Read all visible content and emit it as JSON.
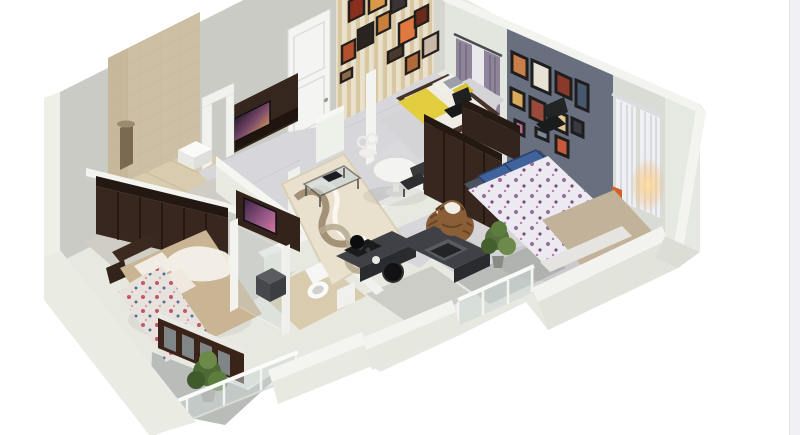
{
  "meta": {
    "title": "3D isometric floor plan render - two-bedroom apartment",
    "render_style": "photorealistic cutaway dollhouse view",
    "visible_text": ""
  },
  "canvas": {
    "width": 800,
    "height": 435,
    "background": "#ffffff"
  },
  "scrollbar": {
    "track_color": "#f1f1f3",
    "edge_color": "#e4e4e8"
  },
  "colors": {
    "wall_mass": "#e7e9e1",
    "wall_gray": "#c9cbc4",
    "wall_cap": "#f3f4f0",
    "wall_window": "#e3e5df",
    "accent_wall": "#68707f",
    "wall_right": "#d9dbd5",
    "wall_right_outer": "#e6e8e2",
    "wallpaper_a": "#f2ead6",
    "wallpaper_b": "#dfcea6",
    "tile_wall": "#cdbfa4",
    "floor_marble": "#d7d7db",
    "floor_master": "#d0cdc6",
    "floor_bath": "#d8cbae",
    "floor_balcony": "#b9bcb9",
    "floor_bed2": "#d6d4d6",
    "counter_top": "#3f4146",
    "counter_front": "#292b2f",
    "wood_dark": "#38271e",
    "wood_door": "#3a241a",
    "door_white": "#f4f4f2",
    "bed_tan": "#c9b494",
    "duvet_floral": "#eceaf0",
    "blanket_beige": "#c2b299",
    "pillow_blue": "#41639c",
    "throw_yellow": "#e2cd3f",
    "curtain_purple": "#8f8499",
    "curtain_white": "#eef0f3",
    "plant_green": "#55703c",
    "glass": "#ccd6d6",
    "rug_base": "#e9e1cd",
    "rug_wave": "#9b8a6e",
    "lamp_glow": "#f2c070"
  },
  "scene": {
    "type": "apartment-floorplan-3d",
    "rooms": [
      {
        "id": "living-room",
        "contents": [
          "tv-unit",
          "wall-tv",
          "white-paneled-door",
          "glass-coffee-table",
          "wavy-area-rug",
          "marble-floor"
        ]
      },
      {
        "id": "dining-area",
        "contents": [
          "round-white-table",
          "white-chair",
          "dark-chair",
          "wicker-basket-chair"
        ]
      },
      {
        "id": "kids-bedroom",
        "contents": [
          "striped-wallpaper",
          "picture-frame-gallery",
          "single-bed-yellow-throw",
          "purple-curtain-window",
          "black-chair",
          "dark-desk"
        ]
      },
      {
        "id": "bathroom-1",
        "contents": [
          "beige-tile-wall",
          "shower-column",
          "white-wash-basin"
        ]
      },
      {
        "id": "master-bedroom",
        "contents": [
          "dark-wardrobe-row",
          "double-bed-tan-duvet",
          "floral-throw",
          "white-pillows",
          "tv-cabinet",
          "french-doors",
          "nightstand"
        ]
      },
      {
        "id": "master-balcony",
        "contents": [
          "potted-plant",
          "glass-railing",
          "gray-floor"
        ]
      },
      {
        "id": "bathroom-2",
        "contents": [
          "toilet",
          "water-heater",
          "beige-tile-floor"
        ]
      },
      {
        "id": "kitchen",
        "contents": [
          "l-shaped-dark-counter",
          "sink",
          "hob-burners",
          "stock-pot"
        ]
      },
      {
        "id": "bedroom-2",
        "contents": [
          "slate-accent-wall",
          "picture-frame-gallery",
          "double-bed-floral-duvet",
          "blue-pillows",
          "dark-wardrobe",
          "white-curtains",
          "warm-lamp",
          "black-chair"
        ]
      },
      {
        "id": "bedroom-2-balcony",
        "contents": [
          "glass-railing",
          "gray-floor"
        ]
      },
      {
        "id": "hallway",
        "contents": [
          "wicker-basket",
          "potted-plant",
          "marble-floor"
        ]
      }
    ]
  }
}
